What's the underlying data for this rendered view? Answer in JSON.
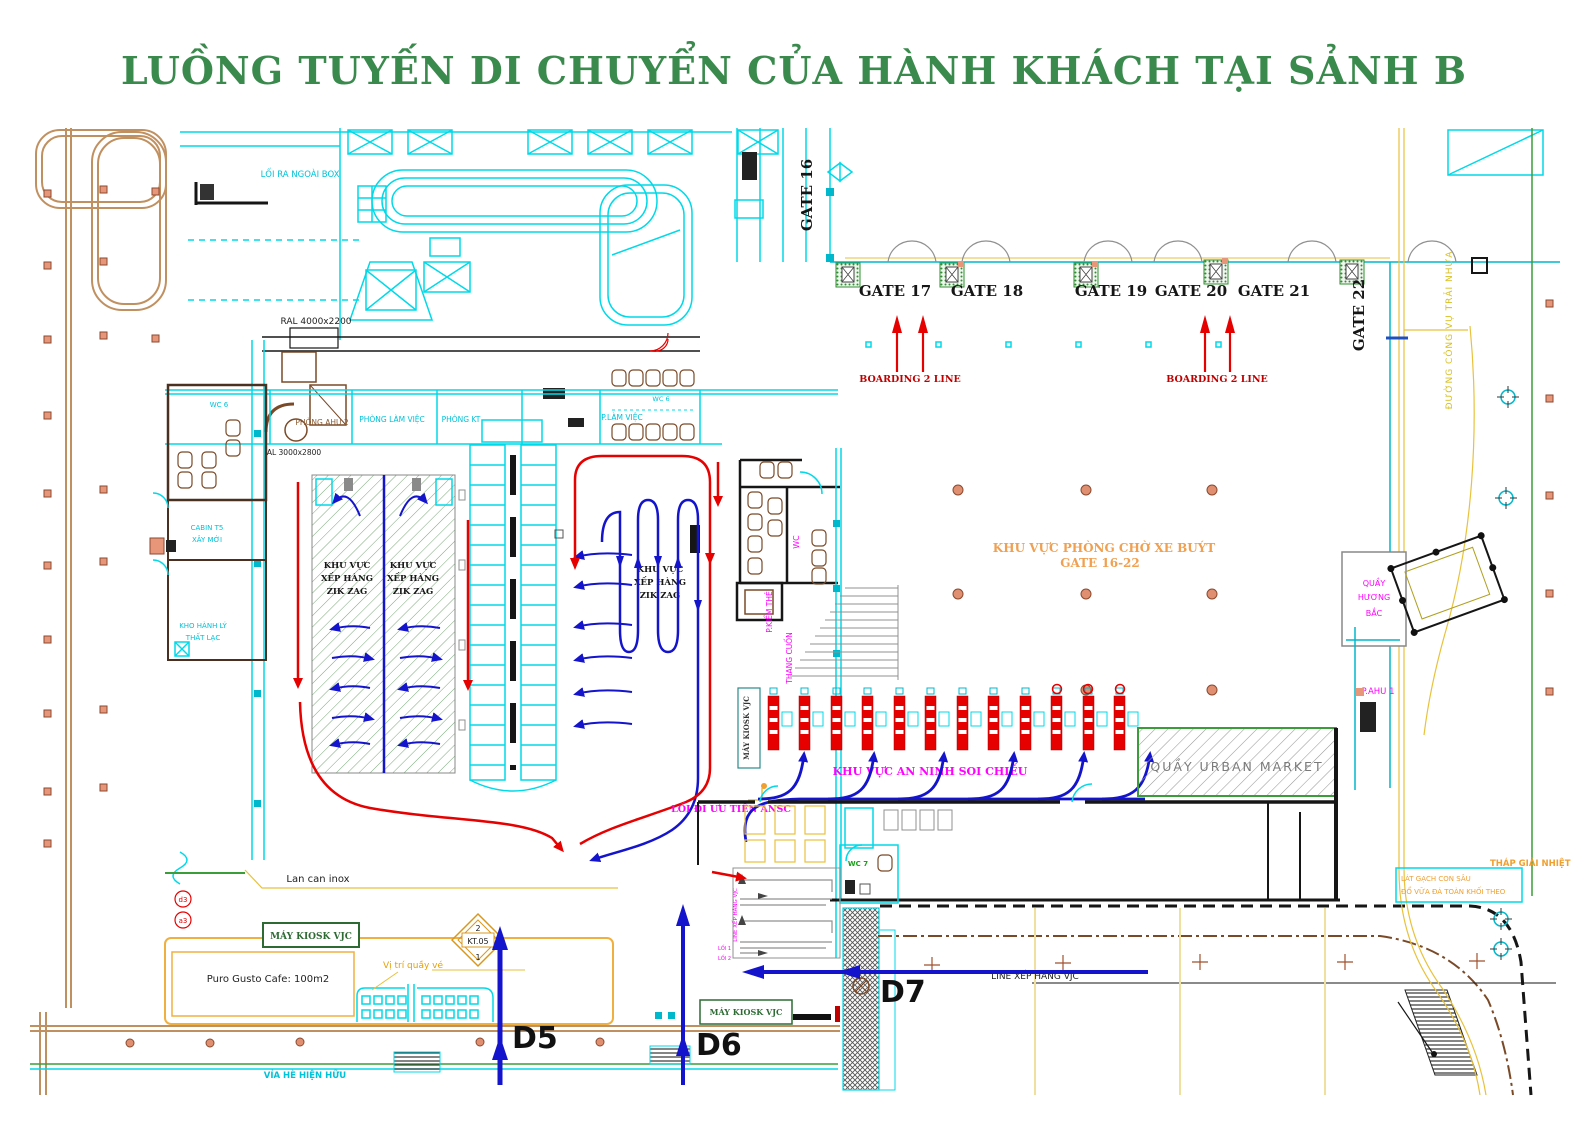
{
  "page": {
    "title": "LUỒNG TUYẾN DI CHUYỂN CỦA HÀNH KHÁCH TẠI SẢNH B"
  },
  "colors": {
    "title_green": "#3a8a4d",
    "wall_cyan": "#00d9e8",
    "flow_blue": "#1414cc",
    "flow_red": "#e60000",
    "label_magenta": "#ff00ff",
    "label_orange": "#f09850",
    "road_yellow": "#e8c23c",
    "curb_brown": "#b08050",
    "boundary_green": "#3a9d3a",
    "boarding_red": "#c00000",
    "hatch_green": "#79a879"
  },
  "gates": {
    "g16": "GATE 16",
    "g17": "GATE 17",
    "g18": "GATE 18",
    "g19": "GATE 19",
    "g20": "GATE 20",
    "g21": "GATE 21",
    "g22": "GATE 22"
  },
  "flows": {
    "boarding": "BOARDING 2 LINE",
    "security": "KHU VỰC AN NINH SOI CHIẾU",
    "priority": "LỐI ĐI ƯU TIÊN ANSC",
    "line_vjc": "LINE XẾP HÀNG VJC",
    "d5": "D5",
    "d6": "D6",
    "d7": "D7"
  },
  "areas": {
    "bus_wait_1": "KHU VỰC PHÒNG CHỜ XE BUÝT",
    "bus_wait_2": "GATE 16-22",
    "zigzag_1": "KHU VỰC",
    "zigzag_2": "XẾP HÀNG",
    "zigzag_3": "ZIK ZAG",
    "urban_market": "QUẦY URBAN MARKET",
    "huong_bac_1": "QUẦY",
    "huong_bac_2": "HƯƠNG",
    "huong_bac_3": "BẮC",
    "p_ahu1": "P.AHU 1"
  },
  "rooms": {
    "wc6_left": "WC 6",
    "cabin_1": "CABIN T5",
    "cabin_2": "XÂY MỚI",
    "kho_1": "KHO HÀNH LÝ",
    "kho_2": "THẤT LẠC",
    "phong_ahu2": "PHÒNG AHU 2",
    "phong_lam_viec": "PHÒNG LÀM VIỆC",
    "phong_kt": "PHÒNG KT",
    "p_lam_viec": "P.LÀM VIỆC",
    "wc6_right": "WC 6",
    "wc_mid": "WC",
    "p_kiem_the": "P.KIỂM THẺ",
    "thang_cuon": "THANG CUỐN",
    "wc7": "WC 7",
    "loi_ra_box": "LỐI RA NGOÀI BOX",
    "ral": "RAL 4000x2200",
    "al": "AL 3000x2800"
  },
  "bottom": {
    "lan_can": "Lan can inox",
    "kiosk": "MÁY KIOSK VJC",
    "cafe": "Puro Gusto Cafe: 100m2",
    "vi_tri": "Vị trí quầy vé",
    "kt05": "KT.05",
    "kt05_top": "2",
    "kt05_bot": "1",
    "via_he": "VỈA HÈ HIỆN HỮU",
    "d3": "d3",
    "a3": "a3",
    "loi_1": "LỐI 1",
    "loi_2": "LỐI 2"
  },
  "right": {
    "road": "ĐƯỜNG CÔNG VỤ TRẢI NHỰA",
    "thap": "THÁP GIẢI NHIỆT",
    "note_1": "LÁT GẠCH CON SÂU",
    "note_2": "ĐỔ VỮA ĐÁ TOÀN KHỐI THEO"
  }
}
